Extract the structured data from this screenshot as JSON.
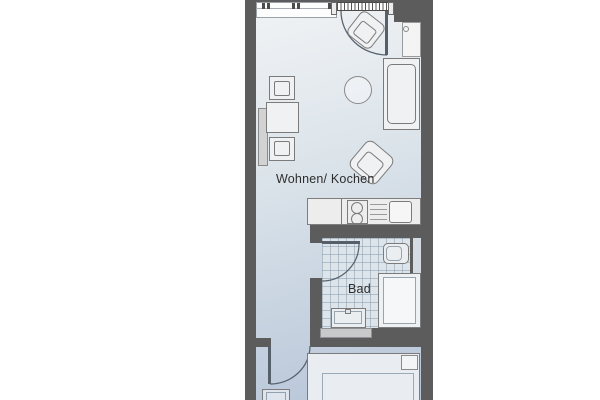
{
  "rooms": {
    "living": {
      "label": "Wohnen/ Kochen"
    },
    "bath": {
      "label": "Bad"
    }
  },
  "colors": {
    "wall": "#5c5c5c",
    "floor_top": "#f1f3f5",
    "floor_mid": "#dde5eb",
    "floor_bottom": "#b7c5d8",
    "tile": "#dee5ea",
    "outline": "#7b7b7b",
    "fill": "#f0f1f2"
  },
  "symbols": [
    "window",
    "balcony-door",
    "door-swing",
    "armchair",
    "round-side-table",
    "sofa",
    "wardrobe",
    "dining-table",
    "chair",
    "radiator",
    "kitchenette",
    "stove",
    "drainer",
    "sink",
    "toilet",
    "shower",
    "washbasin",
    "bed",
    "pillow",
    "desk-chair"
  ]
}
